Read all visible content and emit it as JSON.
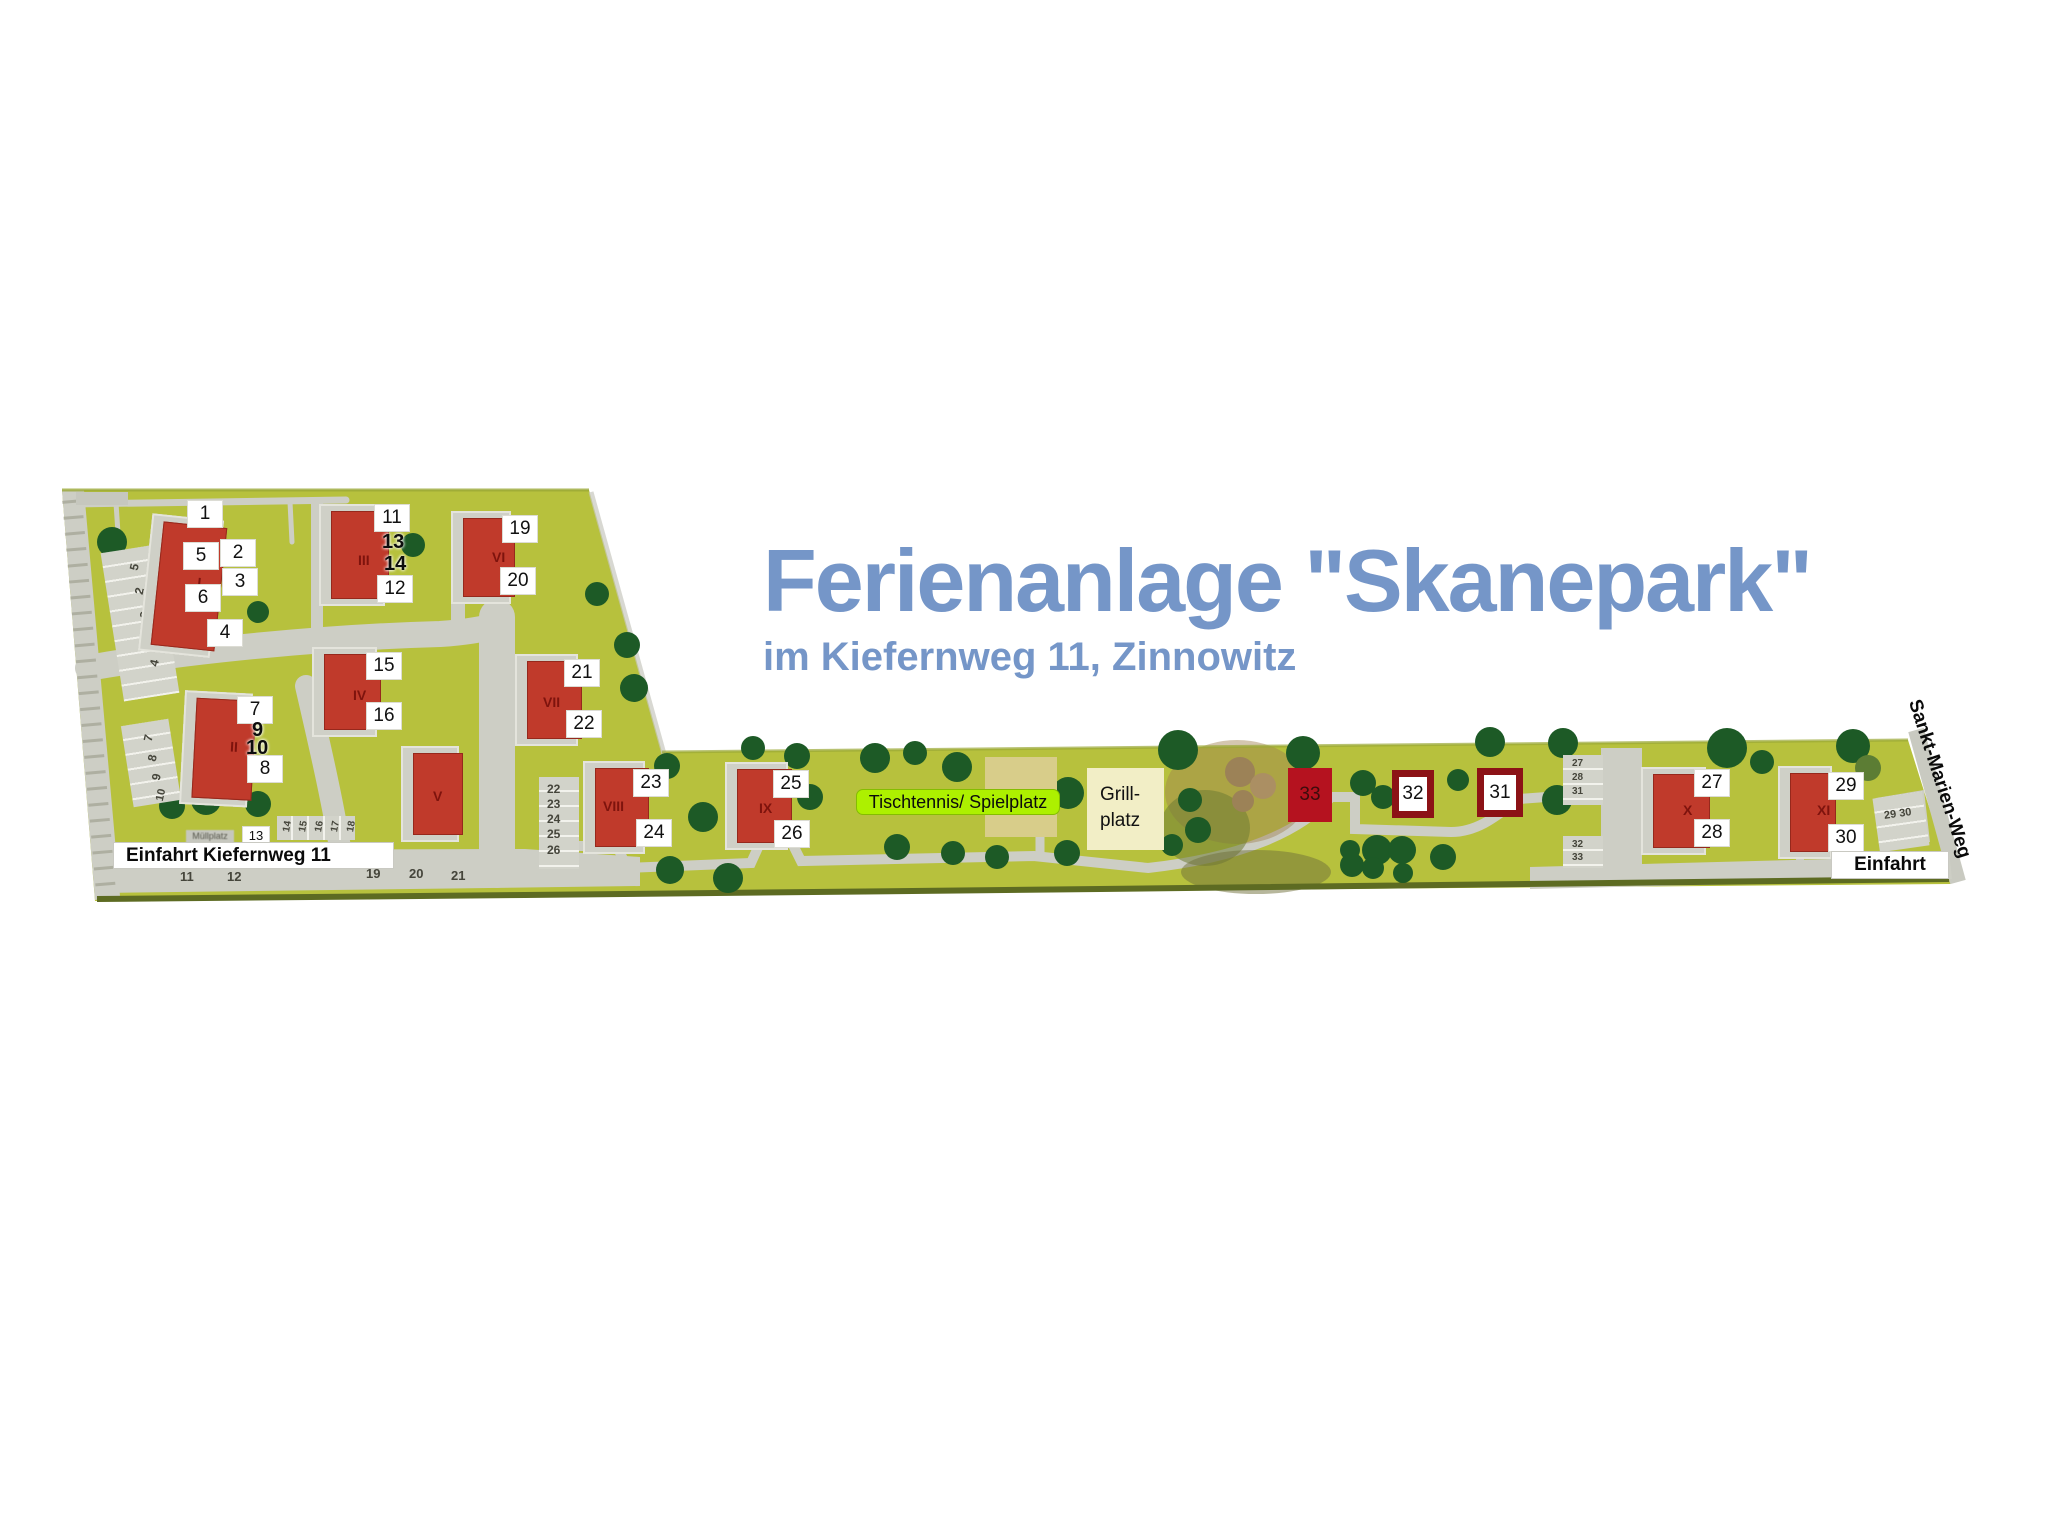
{
  "title": {
    "main": "Ferienanlage \"Skanepark\"",
    "subtitle": "im Kiefernweg 11, Zinnowitz",
    "color": "#7596c8"
  },
  "labels": {
    "entrance_left": "Einfahrt Kiefernweg 11",
    "entrance_right": "Einfahrt",
    "street": "Sankt-Marien-Weg",
    "playground": "Tischtennis/ Spielplatz",
    "grill_line1": "Grill-",
    "grill_line2": "platz",
    "waste": "Müllplatz"
  },
  "colors": {
    "grass": "#b7c13d",
    "road": "#cdcec5",
    "building_red": "#c03a2b",
    "roman_red": "#7e130d",
    "maroon_frame": "#8c1216",
    "crimson_33": "#b5121f",
    "tree_green": "#1d5a26",
    "tree_olive": "#5c7d34",
    "tree_brown": "#9c8257",
    "title_blue": "#7596c8",
    "playground_green": "#adf000",
    "grill_beige": "#f2eec6"
  },
  "map": {
    "buildings": [
      {
        "roman": "I",
        "x": 157,
        "y": 524,
        "w": 64,
        "h": 124,
        "rot": 6,
        "rx": 40,
        "ry": 50
      },
      {
        "roman": "II",
        "x": 194,
        "y": 699,
        "w": 60,
        "h": 100,
        "rot": 3,
        "rx": 36,
        "ry": 40
      },
      {
        "roman": "III",
        "x": 331,
        "y": 511,
        "w": 58,
        "h": 88,
        "rot": 0,
        "rx": 27,
        "ry": 42
      },
      {
        "roman": "IV",
        "x": 324,
        "y": 654,
        "w": 57,
        "h": 76,
        "rot": 0,
        "rx": 29,
        "ry": 34
      },
      {
        "roman": "V",
        "x": 413,
        "y": 753,
        "w": 50,
        "h": 82,
        "rot": 0,
        "rx": 20,
        "ry": 36
      },
      {
        "roman": "VI",
        "x": 463,
        "y": 518,
        "w": 52,
        "h": 79,
        "rot": 0,
        "rx": 29,
        "ry": 32
      },
      {
        "roman": "VII",
        "x": 527,
        "y": 661,
        "w": 55,
        "h": 78,
        "rot": 0,
        "rx": 16,
        "ry": 34
      },
      {
        "roman": "VIII",
        "x": 595,
        "y": 768,
        "w": 54,
        "h": 79,
        "rot": 0,
        "rx": 8,
        "ry": 31
      },
      {
        "roman": "IX",
        "x": 737,
        "y": 769,
        "w": 55,
        "h": 74,
        "rot": 0,
        "rx": 22,
        "ry": 32
      },
      {
        "roman": "X",
        "x": 1653,
        "y": 774,
        "w": 57,
        "h": 74,
        "rot": 0,
        "rx": 30,
        "ry": 29
      },
      {
        "roman": "XI",
        "x": 1790,
        "y": 773,
        "w": 46,
        "h": 79,
        "rot": 0,
        "rx": 27,
        "ry": 30
      }
    ],
    "markers_boxed": [
      {
        "t": "1",
        "x": 188,
        "y": 501
      },
      {
        "t": "5",
        "x": 184,
        "y": 543
      },
      {
        "t": "2",
        "x": 221,
        "y": 540
      },
      {
        "t": "3",
        "x": 223,
        "y": 569
      },
      {
        "t": "6",
        "x": 186,
        "y": 585
      },
      {
        "t": "4",
        "x": 208,
        "y": 620
      },
      {
        "t": "7",
        "x": 238,
        "y": 697
      },
      {
        "t": "8",
        "x": 248,
        "y": 756
      },
      {
        "t": "11",
        "x": 375,
        "y": 505
      },
      {
        "t": "12",
        "x": 378,
        "y": 576
      },
      {
        "t": "15",
        "x": 367,
        "y": 653
      },
      {
        "t": "16",
        "x": 367,
        "y": 703
      },
      {
        "t": "19",
        "x": 503,
        "y": 516
      },
      {
        "t": "20",
        "x": 501,
        "y": 568
      },
      {
        "t": "21",
        "x": 565,
        "y": 660
      },
      {
        "t": "22",
        "x": 567,
        "y": 711
      },
      {
        "t": "23",
        "x": 634,
        "y": 770
      },
      {
        "t": "24",
        "x": 637,
        "y": 820
      },
      {
        "t": "25",
        "x": 774,
        "y": 771
      },
      {
        "t": "26",
        "x": 775,
        "y": 821
      },
      {
        "t": "27",
        "x": 1695,
        "y": 770
      },
      {
        "t": "28",
        "x": 1695,
        "y": 820
      },
      {
        "t": "29",
        "x": 1829,
        "y": 773
      },
      {
        "t": "30",
        "x": 1829,
        "y": 825
      }
    ],
    "markers_plain": [
      {
        "t": "9",
        "x": 252,
        "y": 720
      },
      {
        "t": "10",
        "x": 246,
        "y": 738
      },
      {
        "t": "13",
        "x": 382,
        "y": 532
      },
      {
        "t": "14",
        "x": 384,
        "y": 554
      }
    ],
    "special": [
      {
        "t": "33",
        "x": 1288,
        "y": 768,
        "w": 44,
        "h": 54,
        "style": "solid"
      },
      {
        "t": "32",
        "x": 1392,
        "y": 770,
        "w": 42,
        "h": 48,
        "style": "frame"
      },
      {
        "t": "31",
        "x": 1477,
        "y": 768,
        "w": 46,
        "h": 49,
        "style": "frame"
      }
    ],
    "trees": [
      [
        112,
        542,
        15,
        "g"
      ],
      [
        196,
        628,
        11,
        "g"
      ],
      [
        258,
        612,
        11,
        "g"
      ],
      [
        413,
        545,
        12,
        "g"
      ],
      [
        597,
        594,
        12,
        "g"
      ],
      [
        627,
        645,
        13,
        "g"
      ],
      [
        634,
        688,
        14,
        "g"
      ],
      [
        172,
        806,
        13,
        "g"
      ],
      [
        206,
        800,
        15,
        "g"
      ],
      [
        258,
        804,
        13,
        "g"
      ],
      [
        667,
        766,
        13,
        "g"
      ],
      [
        753,
        748,
        12,
        "g"
      ],
      [
        797,
        756,
        13,
        "g"
      ],
      [
        703,
        817,
        15,
        "g"
      ],
      [
        810,
        797,
        13,
        "g"
      ],
      [
        670,
        870,
        14,
        "g"
      ],
      [
        728,
        878,
        15,
        "g"
      ],
      [
        875,
        758,
        15,
        "g"
      ],
      [
        915,
        753,
        12,
        "g"
      ],
      [
        957,
        767,
        15,
        "g"
      ],
      [
        897,
        847,
        13,
        "g"
      ],
      [
        953,
        853,
        12,
        "g"
      ],
      [
        997,
        857,
        12,
        "g"
      ],
      [
        1068,
        793,
        16,
        "g"
      ],
      [
        1067,
        853,
        13,
        "g"
      ],
      [
        1178,
        750,
        20,
        "g"
      ],
      [
        1190,
        800,
        12,
        "g"
      ],
      [
        1198,
        830,
        13,
        "g"
      ],
      [
        1172,
        845,
        11,
        "g"
      ],
      [
        1240,
        772,
        15,
        "b"
      ],
      [
        1263,
        786,
        13,
        "b2"
      ],
      [
        1243,
        801,
        11,
        "b"
      ],
      [
        1303,
        753,
        17,
        "g"
      ],
      [
        1363,
        783,
        13,
        "g"
      ],
      [
        1383,
        797,
        12,
        "g"
      ],
      [
        1352,
        865,
        12,
        "g"
      ],
      [
        1377,
        850,
        15,
        "g"
      ],
      [
        1402,
        850,
        14,
        "g"
      ],
      [
        1350,
        850,
        10,
        "g"
      ],
      [
        1373,
        868,
        11,
        "g"
      ],
      [
        1403,
        873,
        10,
        "g"
      ],
      [
        1443,
        857,
        13,
        "g"
      ],
      [
        1490,
        742,
        15,
        "g"
      ],
      [
        1458,
        780,
        11,
        "g"
      ],
      [
        1563,
        743,
        15,
        "g"
      ],
      [
        1557,
        800,
        15,
        "g"
      ],
      [
        1727,
        748,
        20,
        "g"
      ],
      [
        1762,
        762,
        12,
        "g"
      ],
      [
        1853,
        746,
        17,
        "g"
      ],
      [
        1868,
        768,
        13,
        "o"
      ]
    ],
    "parking": {
      "strips": [
        {
          "x": 112,
          "y": 548,
          "w": 56,
          "h": 150,
          "rot": -9,
          "bays": "v"
        },
        {
          "x": 127,
          "y": 722,
          "w": 48,
          "h": 82,
          "rot": -9,
          "bays": "v"
        },
        {
          "x": 277,
          "y": 816,
          "w": 78,
          "h": 24,
          "rot": 0,
          "bays": "h"
        },
        {
          "x": 539,
          "y": 777,
          "w": 40,
          "h": 92,
          "rot": 0,
          "bays": "v"
        },
        {
          "x": 1563,
          "y": 755,
          "w": 40,
          "h": 50,
          "rot": 0,
          "bays": "v"
        },
        {
          "x": 1563,
          "y": 836,
          "w": 40,
          "h": 32,
          "rot": 0,
          "bays": "v"
        },
        {
          "x": 1876,
          "y": 795,
          "w": 50,
          "h": 54,
          "rot": -8,
          "bays": "v"
        }
      ],
      "texts": [
        {
          "t": "5",
          "x": 131,
          "y": 560,
          "rot": -77,
          "fs": 12
        },
        {
          "t": "2",
          "x": 136,
          "y": 584,
          "rot": -77,
          "fs": 12
        },
        {
          "t": "3",
          "x": 141,
          "y": 608,
          "rot": -77,
          "fs": 12
        },
        {
          "t": "6",
          "x": 146,
          "y": 632,
          "rot": -77,
          "fs": 12
        },
        {
          "t": "4",
          "x": 151,
          "y": 656,
          "rot": -77,
          "fs": 12
        },
        {
          "t": "7",
          "x": 145,
          "y": 731,
          "rot": -77,
          "fs": 12
        },
        {
          "t": "8",
          "x": 149,
          "y": 751,
          "rot": -77,
          "fs": 12
        },
        {
          "t": "9",
          "x": 153,
          "y": 770,
          "rot": -77,
          "fs": 12
        },
        {
          "t": "10",
          "x": 155,
          "y": 789,
          "rot": -77,
          "fs": 11
        },
        {
          "t": "14",
          "x": 282,
          "y": 821,
          "rot": -80,
          "fs": 10
        },
        {
          "t": "15",
          "x": 298,
          "y": 821,
          "rot": -80,
          "fs": 10
        },
        {
          "t": "16",
          "x": 314,
          "y": 821,
          "rot": -80,
          "fs": 10
        },
        {
          "t": "17",
          "x": 330,
          "y": 821,
          "rot": -80,
          "fs": 10
        },
        {
          "t": "18",
          "x": 346,
          "y": 821,
          "rot": -80,
          "fs": 10
        },
        {
          "t": "22",
          "x": 547,
          "y": 782,
          "rot": 0,
          "fs": 12
        },
        {
          "t": "23",
          "x": 547,
          "y": 797,
          "rot": 0,
          "fs": 12
        },
        {
          "t": "24",
          "x": 547,
          "y": 812,
          "rot": 0,
          "fs": 12
        },
        {
          "t": "25",
          "x": 547,
          "y": 827,
          "rot": 0,
          "fs": 12
        },
        {
          "t": "26",
          "x": 547,
          "y": 843,
          "rot": 0,
          "fs": 12
        },
        {
          "t": "27",
          "x": 1572,
          "y": 758,
          "rot": 0,
          "fs": 10
        },
        {
          "t": "28",
          "x": 1572,
          "y": 772,
          "rot": 0,
          "fs": 10
        },
        {
          "t": "31",
          "x": 1572,
          "y": 786,
          "rot": 0,
          "fs": 10
        },
        {
          "t": "32",
          "x": 1572,
          "y": 839,
          "rot": 0,
          "fs": 10
        },
        {
          "t": "33",
          "x": 1572,
          "y": 852,
          "rot": 0,
          "fs": 10
        },
        {
          "t": "29 30",
          "x": 1884,
          "y": 808,
          "rot": -8,
          "fs": 11
        },
        {
          "t": "11",
          "x": 180,
          "y": 869,
          "rot": 0,
          "fs": 13
        },
        {
          "t": "12",
          "x": 227,
          "y": 869,
          "rot": 0,
          "fs": 13
        },
        {
          "t": "19",
          "x": 366,
          "y": 866,
          "rot": 0,
          "fs": 13
        },
        {
          "t": "20",
          "x": 409,
          "y": 866,
          "rot": 0,
          "fs": 13
        },
        {
          "t": "21",
          "x": 451,
          "y": 868,
          "rot": 0,
          "fs": 13
        }
      ],
      "box13": {
        "t": "13",
        "x": 243,
        "y": 827
      }
    }
  }
}
